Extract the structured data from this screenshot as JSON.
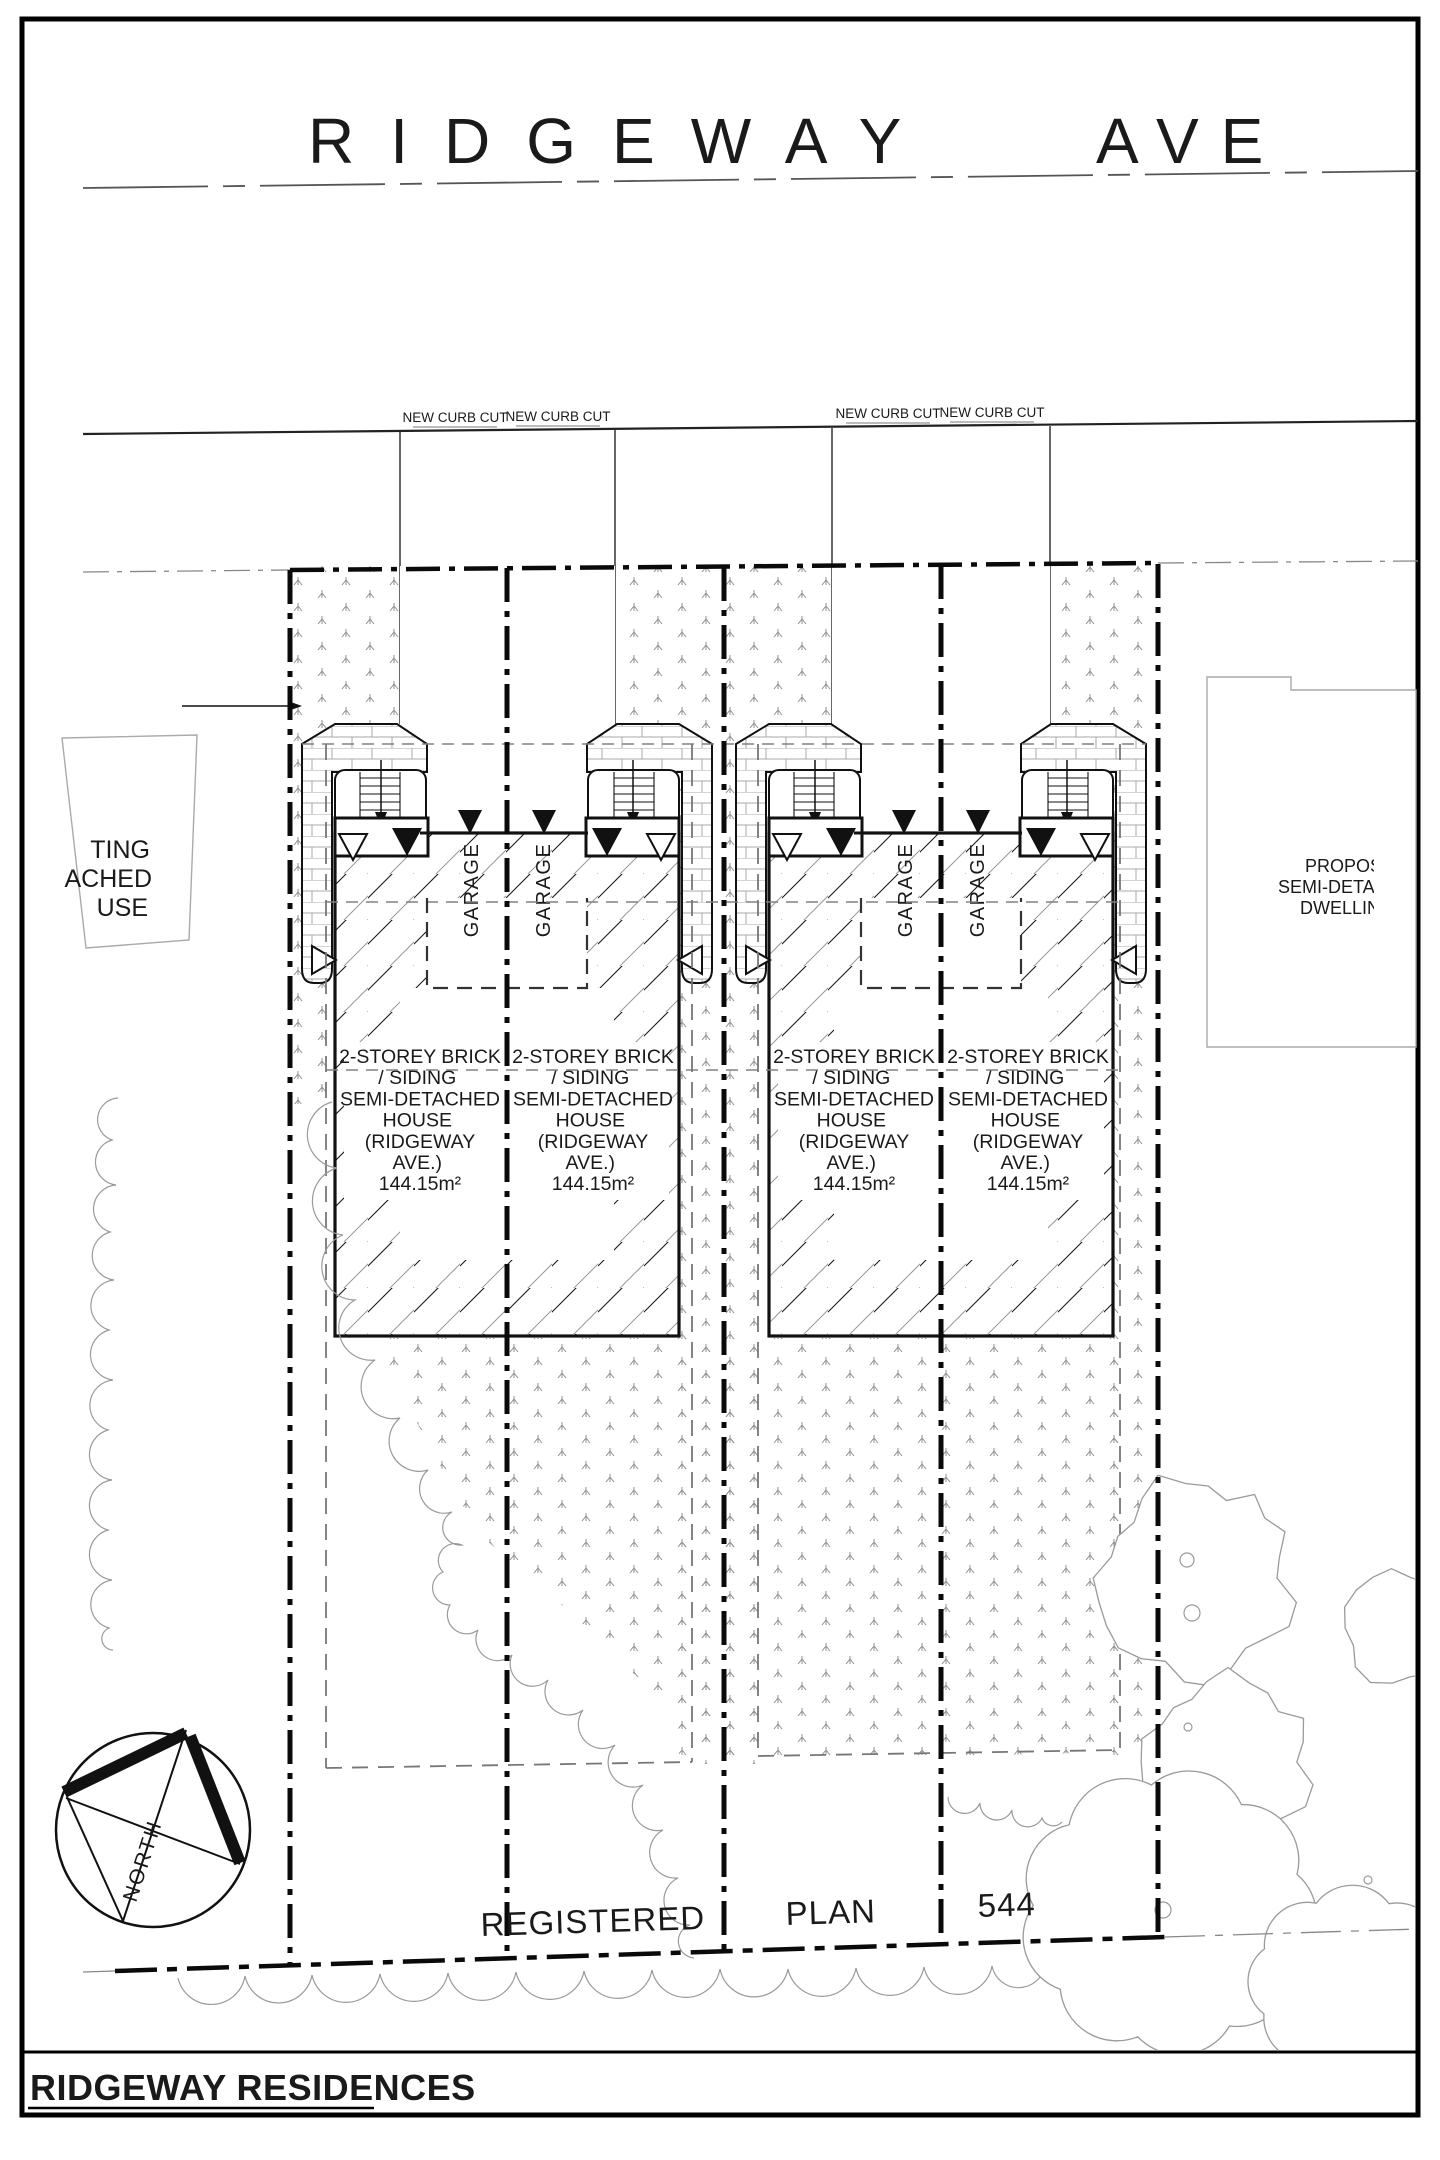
{
  "street": {
    "name_part1": "RIDGEWAY",
    "name_part2": "AVE",
    "curb_cut_labels": [
      "NEW CURB CUT",
      "NEW CURB CUT",
      "NEW CURB CUT",
      "NEW CURB CUT"
    ]
  },
  "units": [
    {
      "garage_label": "GARAGE",
      "lines": [
        "2-STOREY BRICK",
        "/ SIDING",
        "SEMI-DETACHED",
        "HOUSE",
        "(RIDGEWAY",
        "AVE.)",
        "144.15m²"
      ]
    },
    {
      "garage_label": "GARAGE",
      "lines": [
        "2-STOREY BRICK",
        "/ SIDING",
        "SEMI-DETACHED",
        "HOUSE",
        "(RIDGEWAY",
        "AVE.)",
        "144.15m²"
      ]
    },
    {
      "garage_label": "GARAGE",
      "lines": [
        "2-STOREY BRICK",
        "/ SIDING",
        "SEMI-DETACHED",
        "HOUSE",
        "(RIDGEWAY",
        "AVE.)",
        "144.15m²"
      ]
    },
    {
      "garage_label": "GARAGE",
      "lines": [
        "2-STOREY BRICK",
        "/ SIDING",
        "SEMI-DETACHED",
        "HOUSE",
        "(RIDGEWAY",
        "AVE.)",
        "144.15m²"
      ]
    }
  ],
  "neighbors": {
    "left_fragments": [
      "TING",
      "ACHED",
      "USE"
    ],
    "right_fragments": [
      "PROPOS",
      "SEMI-DETA",
      "DWELLIN"
    ]
  },
  "plan_note": {
    "word1": "REGISTERED",
    "word2": "PLAN",
    "word3": "544"
  },
  "compass": {
    "label": "NORTH"
  },
  "title_block": {
    "project_name": "RIDGEWAY RESIDENCES"
  },
  "colors": {
    "ink": "#1a1a1a",
    "gray": "#9a9a9a",
    "stipple": "#8f8f8f",
    "dash_gray": "#808080"
  }
}
